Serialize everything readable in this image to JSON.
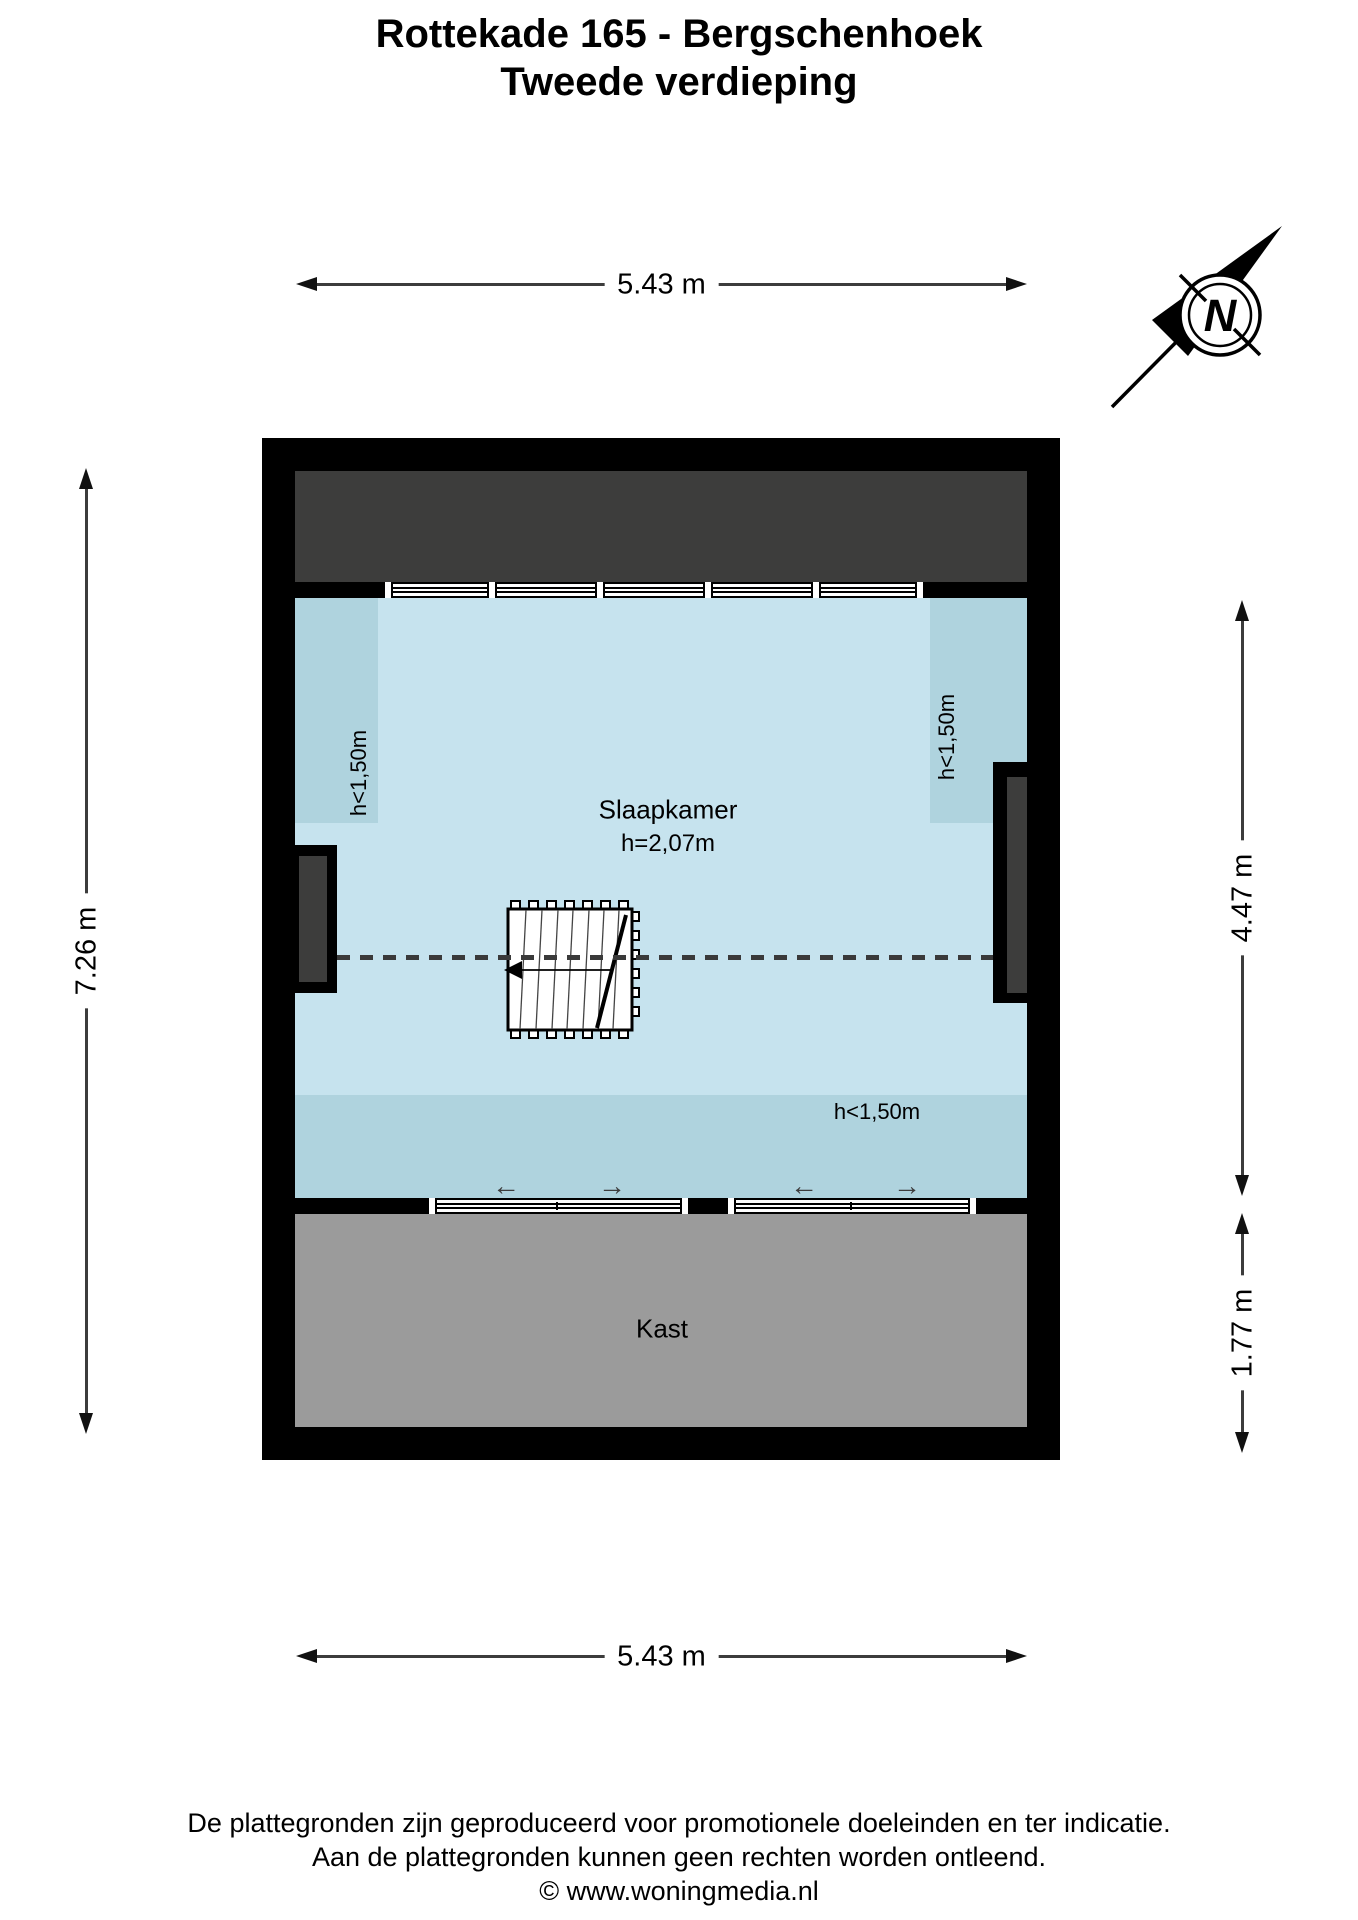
{
  "title": {
    "line1": "Rottekade 165 - Bergschenhoek",
    "line2": "Tweede verdieping"
  },
  "compass": {
    "letter": "N"
  },
  "dimensions": {
    "top": "5.43 m",
    "bottom": "5.43 m",
    "left": "7.26 m",
    "right_upper": "4.47 m",
    "right_lower": "1.77 m"
  },
  "plan": {
    "bedroom": {
      "name": "Slaapkamer",
      "ceiling_height": "h=2,07m"
    },
    "closet": {
      "name": "Kast"
    },
    "low_height": {
      "left": "h<1,50m",
      "right": "h<1,50m",
      "bottom": "h<1,50m"
    }
  },
  "icons": {
    "compass": "compass-north-arrow",
    "slide_left": "←",
    "slide_right": "→"
  },
  "footer": {
    "line1": "De plattegronden zijn geproduceerd voor promotionele doeleinden en ter indicatie.",
    "line2": "Aan de plattegronden kunnen geen rechten worden ontleend.",
    "line3": "© www.woningmedia.nl"
  },
  "colors": {
    "room_blue": "#c6e3ee",
    "low_ceiling_blue": "#afd3de",
    "roof_gray": "#3d3d3c",
    "closet_gray": "#9b9b9b",
    "wall_black": "#000000"
  }
}
